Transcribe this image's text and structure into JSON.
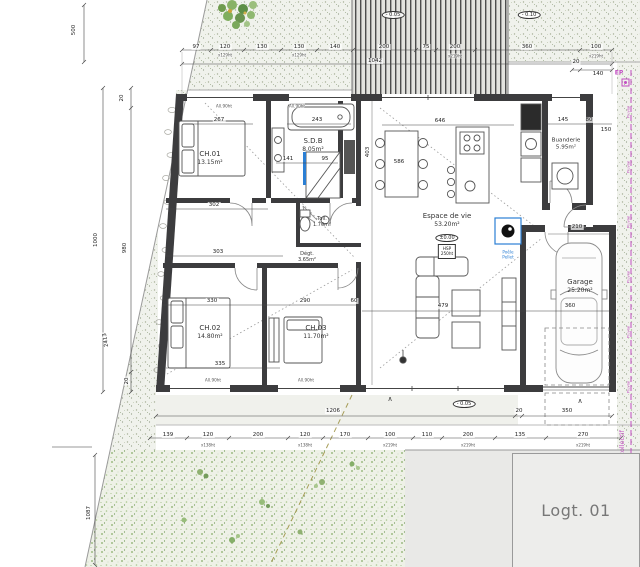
{
  "plan": {
    "rooms": {
      "ch01": {
        "name": "CH.01",
        "area": "13.15m²"
      },
      "sdb": {
        "name": "S.D.B",
        "area": "8.05m²"
      },
      "toil": {
        "name": "Toil.",
        "area": "1.70m²"
      },
      "degt": {
        "name": "Dégt.",
        "area": "3.65m²"
      },
      "ch02": {
        "name": "CH.02",
        "area": "14.80m²"
      },
      "ch03": {
        "name": "CH.03",
        "area": "11.70m²"
      },
      "vie": {
        "name": "Espace de vie",
        "area": "53.20m²"
      },
      "buanderie": {
        "name": "Buanderie",
        "area": "5.95m²"
      },
      "garage": {
        "name": "Garage",
        "area": "25.20m²"
      }
    },
    "unit_label": "Logt. 01",
    "levels": {
      "zero": "±0.00",
      "m005": "- 0.05",
      "m010": "- 0.10",
      "hsp1": "HSP",
      "hsp2": "250ht"
    },
    "stove": {
      "l1": "Poêle",
      "l2": "Pellet"
    },
    "ep": {
      "tag": "EP",
      "note": "EP vers réseau collectif",
      "line_tag": "Pluvial"
    },
    "window_tag": "All.90ht",
    "entry_marker": "∧",
    "dims": {
      "top": [
        "97",
        "120",
        "130",
        "130",
        "140",
        "200",
        "75",
        "200",
        "360",
        "100"
      ],
      "top_total": "1042",
      "top_right_a": "20",
      "top_right_b": "140",
      "win_tag_small": "x129ht",
      "win_tag_mid": "x138ht",
      "win_tag_big": "x219ht",
      "left": {
        "l500": "500",
        "l1000": "1000",
        "l980": "980",
        "l20": "20",
        "l1087": "1087",
        "l2413": "2413"
      },
      "bottom": [
        "139",
        "120",
        "200",
        "120",
        "170",
        "100",
        "110",
        "200",
        "135",
        "270"
      ],
      "terrace": {
        "t1206": "1206",
        "t20": "20",
        "t350": "350"
      },
      "inner": {
        "i267": "267",
        "i243": "243",
        "i646": "646",
        "i145": "145",
        "i80": "80",
        "i150": "150",
        "i302": "302",
        "i303": "303",
        "i330": "330",
        "i290": "290",
        "i60": "60",
        "i335": "335",
        "i141": "141",
        "i95": "95",
        "i586": "586",
        "i210": "210",
        "i479": "479",
        "i360": "360",
        "i403": "403"
      }
    }
  }
}
